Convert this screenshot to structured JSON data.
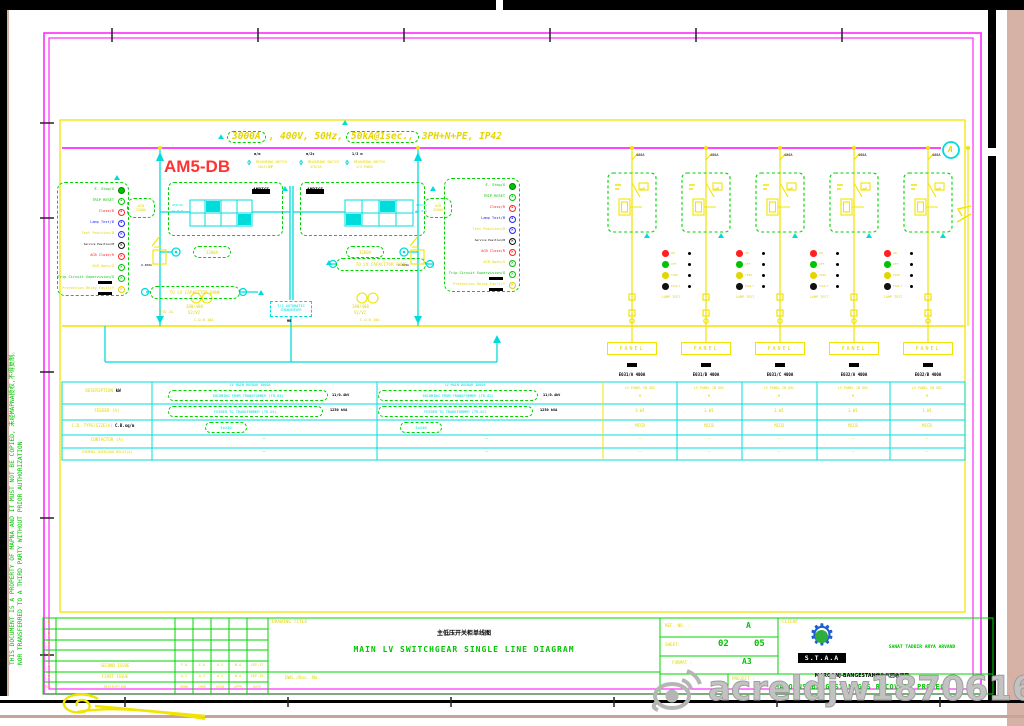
{
  "spec": {
    "amp": "3000A",
    "mid": ", 400V, 50Hz, ",
    "fault": "50kA@1sec.,",
    "tail": " 3PH+N+PE, IP42",
    "bus_ref": "A"
  },
  "tag": "AM5-DB",
  "switches": [
    {
      "top": "m/m",
      "l1": "MEASURING SWITCH",
      "l2": "VOLT/AMP"
    },
    {
      "top": "m/2s",
      "l1": "MEASURING SWITCH",
      "l2": "470/5A"
    },
    {
      "top": "1/3 m",
      "l1": "MEASURING SWITCH",
      "l2": "1/3 PHASE"
    }
  ],
  "legend": {
    "items": [
      {
        "label": "E. Stop/G"
      },
      {
        "label": "TRIP RESET"
      },
      {
        "label": "Close/R"
      },
      {
        "label": "Lamp Test/B"
      },
      {
        "label": "Test Position/B"
      },
      {
        "label": "Service Position/B"
      },
      {
        "label": "ACB Close/R"
      },
      {
        "label": "ACB Open/G"
      },
      {
        "label": "Trip Circuit Supervision/G"
      },
      {
        "label": "Protection Relay Fault/Y"
      }
    ]
  },
  "incomer": {
    "meter": "AMPICS",
    "cap": "TO LV CAPACITOR BANK",
    "co1": "I/2 AUTOMATIC",
    "co2": "CHANGEOVER",
    "ratio": "380/400",
    "taps": "V2/V2",
    "aux1": "C.O.B 10A",
    "aux2": "FTD 2A",
    "cb": "3200A",
    "mb": "MB",
    "ct": "O-400A"
  },
  "feeders": {
    "panel": "PANEL",
    "rating": "400A",
    "names": [
      "E031/A 400A",
      "E031/B 400A",
      "E031/C 400A",
      "E032/A 400A",
      "E032/B 400A"
    ],
    "lamps": [
      "ON",
      "OFF",
      "TRIP",
      "FAULT"
    ],
    "lamptest": "LAMP TEST"
  },
  "schedule": {
    "labels": [
      "DESCRIPTION",
      "FEEDER (A)",
      "C.B. TYPE/SIZE(A)",
      "CONTACTOR (A)",
      "THERMAL OVERLOAD RELAY(A)"
    ],
    "kw": "kW",
    "note": "C.B.sq/m",
    "a": {
      "bus": "LV MAIN BUSBAR 3000A",
      "r1": "INCOMING FROM TRANSFORMER (TR-01)",
      "r1b": "11/0.4kV",
      "r2": "FEEDER TO TRANSFORMER (TR-01)",
      "r2b": "1250 kVA",
      "r3": "3x240",
      "dash": "—"
    },
    "b": {
      "bus": "LV MAIN BUSBAR 3000A",
      "r1": "INCOMING FROM TRANSFORMER (TR-02)",
      "r1b": "11/0.4kV",
      "r2": "FEEDER TO TRANSFORMER (TR-02)",
      "r2b": "1250 kVA",
      "r3": "3x240",
      "dash": "—"
    },
    "f": {
      "r1": "LV PANEL IN GRC",
      "r1b": "M",
      "r2": "3.W1",
      "r3": "MCCB",
      "dash": "—"
    }
  },
  "tb": {
    "rev": {
      "rows": [
        {
          "rev": "E",
          "desc": "",
          "d1": "",
          "d2": "",
          "d3": "",
          "d4": "",
          "date": ""
        },
        {
          "rev": "D",
          "desc": "",
          "d1": "",
          "d2": "",
          "d3": "",
          "d4": "",
          "date": ""
        },
        {
          "rev": "C",
          "desc": "",
          "d1": "",
          "d2": "",
          "d3": "",
          "d4": "",
          "date": ""
        },
        {
          "rev": "B",
          "desc": "",
          "d1": "",
          "d2": "",
          "d3": "",
          "d4": "",
          "date": ""
        },
        {
          "rev": "A",
          "desc": "SECOND ISSUE",
          "d1": "F.K",
          "d2": "F.K",
          "d3": "A.Y",
          "d4": "N.A",
          "date": "SEP.17"
        },
        {
          "rev": "0",
          "desc": "FIRST ISSUE",
          "d1": "A.Y",
          "d2": "A.Y",
          "d3": "A.Y",
          "d4": "N.A",
          "date": "SEP.16"
        }
      ],
      "header": {
        "rev": "REV.",
        "desc": "DESCRIPTION",
        "d1": "DRWN",
        "d2": "CHKD",
        "d3": "DSGN",
        "d4": "APPR",
        "date": "DATE"
      }
    },
    "drawing_title_label": "DRAWING TITLE",
    "title_cn": "主低压开关柜单线图",
    "title_en": "MAIN LV SWITCHGEAR SINGLE LINE DIAGRAM",
    "dwg_no_label": "DWG./Doc. No.",
    "ref_label": "REF. NO. :",
    "ref_value": "A",
    "sheet_label": "SHEET:",
    "sheet_value": "02",
    "sheet_of": "05",
    "format_label": "FORMAT :",
    "format_value": "A3",
    "client_label": "CLIENT",
    "logo_text": "S.T.A.A",
    "client_name": "SANAT TADBIR ARYA ARVAND",
    "project_label": "PROJECT :",
    "project_cn": "MAROONJ-BANGESTAN伴生气回收项目",
    "project_en": "MAROONS BANGESTAN GAS RECOVERY PROJECT"
  },
  "note1": "THIS DOCUMENT IS A PROPERTY OF MAPNA AND IT MUST NOT BE COPIED, 未经MAPNA授权,不得复制。",
  "note2": "NOR TRANSFERRED TO A THIRD PARTY WITHOUT PRIOR AUTHORIZATION",
  "wm": "acreldjw18706162527",
  "colors": {
    "cad_yellow": "#f0e400",
    "cad_cyan": "#00dcdc",
    "cad_green": "#00d400",
    "cad_magenta": "#ff2bff",
    "tag_red": "#ff3333",
    "desk_beige": "#d6b2a6",
    "watermark_grey": "#b5b5b5"
  }
}
